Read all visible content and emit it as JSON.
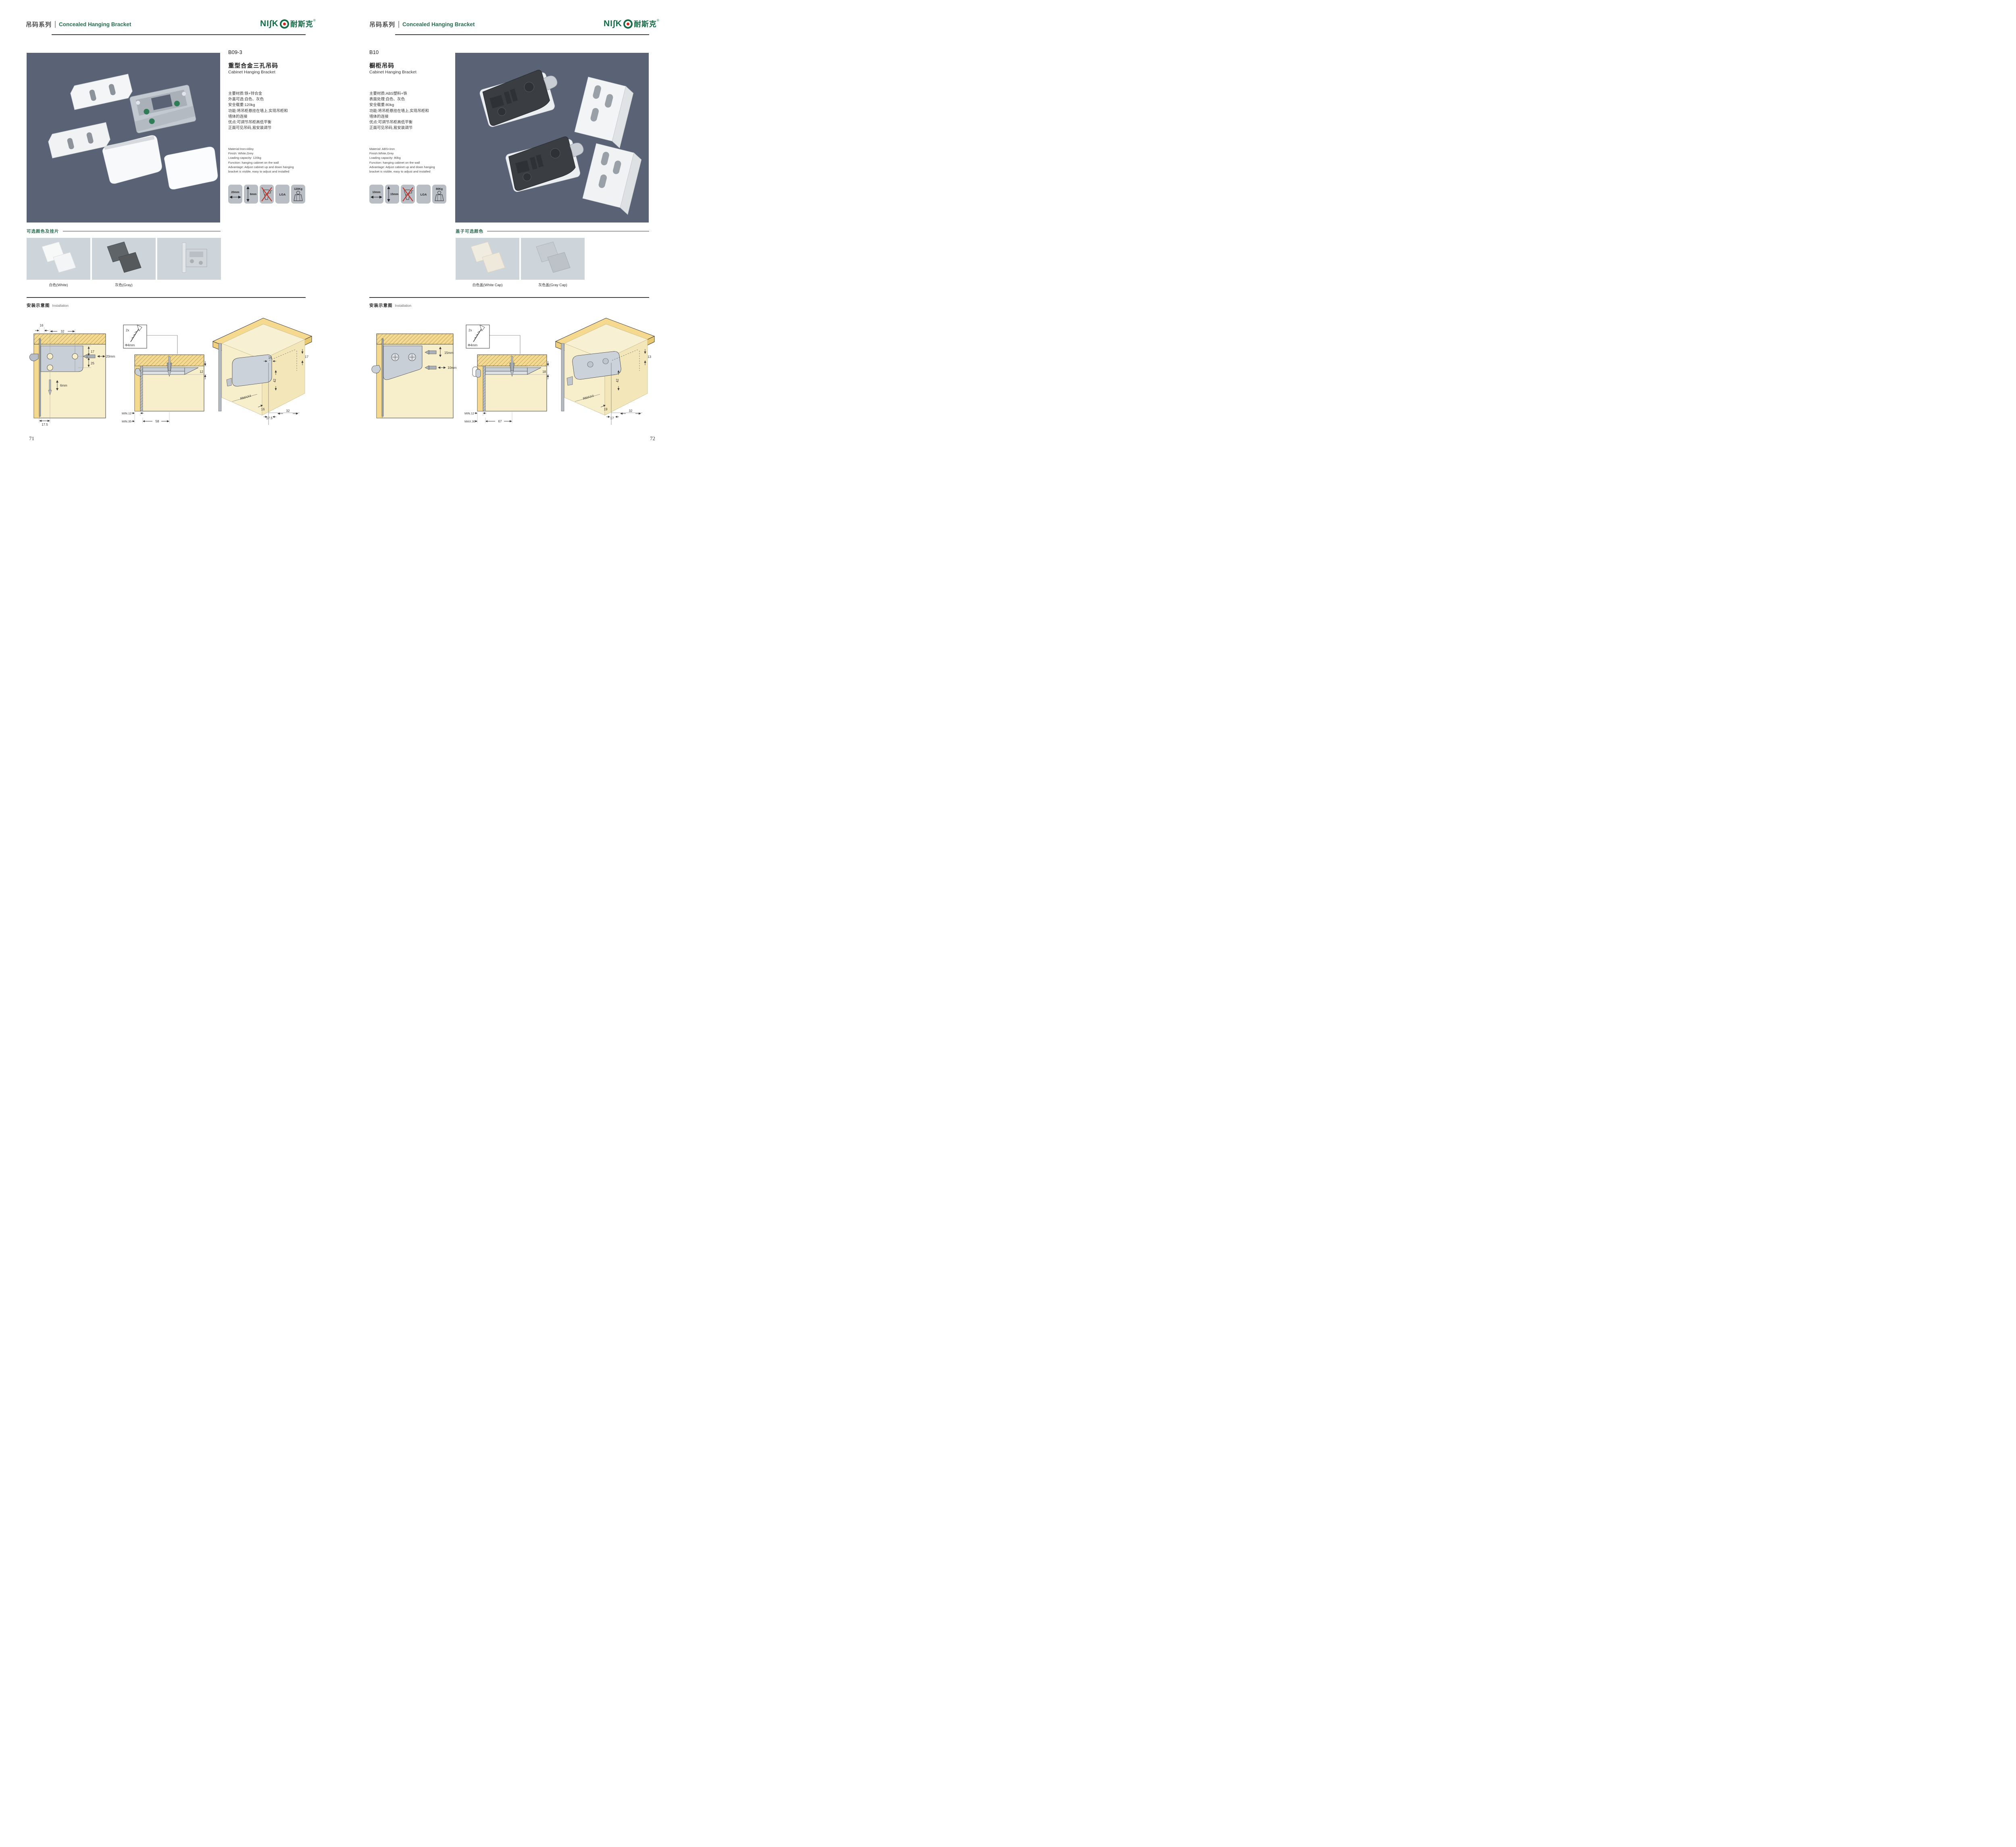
{
  "brand": {
    "logo_prefix": "NI∫K",
    "logo_cn": "耐斯克",
    "registered": "®"
  },
  "header": {
    "series_cn": "吊码系列",
    "series_en": "Concealed Hanging Bracket"
  },
  "pages": [
    {
      "product": {
        "model": "B09-3",
        "name_cn": "重型合金三孔吊码",
        "name_en": "Cabinet Hanging Bracket",
        "specs_cn": [
          "主要材质:铁+锌合金",
          "外盖可选:白色、灰色",
          "安全载重:120kg",
          "功能:将吊柜悬挂在墙上,实现吊柜和",
          "墙体的连接",
          "优点:可调节吊柜高低平衡",
          "正面可见吊码,易安装调节"
        ],
        "specs_en": [
          "Material:Iron+Alloy",
          "Finish: White,Grey",
          "Loading capacity: 120kg",
          "Function: hanging cabinet on the wall",
          "Advantage: Adjust cabinet up and down hanging",
          "bracket is visible, easy to adjust and installed"
        ],
        "icons": {
          "width_label": "20mm",
          "height_label": "6mm",
          "cert_label": "LGA",
          "load_label": "120Kg"
        }
      },
      "colors": {
        "title": "可选颜色及挂片",
        "labels": [
          "白色(White)",
          "灰色(Gray)"
        ]
      },
      "installation": {
        "title_cn": "安装示意图",
        "title_en": "Installation",
        "d1": {
          "off": "16",
          "pitch": "32",
          "top": "17",
          "gap": "25",
          "drill_h": "20mm",
          "drill_v": "6mm",
          "bottom": "17.5"
        },
        "d2": {
          "qty": "2x",
          "dia": "Φ4mm",
          "side": "12",
          "b1": "MIN.12",
          "b2": "MIN.35",
          "span": "58"
        },
        "d3": {
          "a": "17",
          "b": "16",
          "c": "42",
          "r": "RMAX4",
          "d": "16",
          "e": "17.5",
          "f": "32"
        }
      },
      "page_number": "71"
    },
    {
      "product": {
        "model": "B10",
        "name_cn": "橱柜吊码",
        "name_en": "Cabinet Hanging Bracket",
        "specs_cn": [
          "主要材质:ABS塑料+铁",
          "表面处理:白色、灰色",
          "安全载重:80kg",
          "功能:将吊柜悬挂在墙上,实现吊柜和",
          "墙体的连接",
          "优点:可调节吊柜高低平衡",
          "正面可见吊码,易安装调节"
        ],
        "specs_en": [
          "Material: ABS+iron",
          "Finish:White,Grey",
          "Loading capacity: 80kg",
          "Function: hanging cabinet on the wall",
          "Advantage: Adjust cabinet up and down hanging",
          "bracket is visible, easy to adjust and installed"
        ],
        "icons": {
          "width_label": "10mm",
          "height_label": "15mm",
          "cert_label": "LGA",
          "load_label": "80Kg"
        }
      },
      "colors": {
        "title": "盖子可选颜色",
        "labels": [
          "白色盖(White Cap)",
          "灰色盖(Gray Cap)"
        ]
      },
      "installation": {
        "title_cn": "安装示意图",
        "title_en": "Installation",
        "d1": {
          "v": "15mm",
          "h": "10mm"
        },
        "d2": {
          "qty": "2x",
          "dia": "Φ4mm",
          "side": "18",
          "b1": "MIN.12",
          "b2": "MAX.30",
          "span": "67"
        },
        "d3": {
          "a": "13",
          "c": "42",
          "r": "RMAX4",
          "d": "19",
          "e": "17",
          "f": "32"
        }
      },
      "page_number": "72"
    }
  ],
  "colors_meta": {
    "accent_green": "#2a6e52",
    "logo_green": "#176a47",
    "logo_red": "#d2251c",
    "photo_bg": "#5a6375",
    "swatch_bg": "#ced5da",
    "diagram_cream": "#f7eecb",
    "diagram_yellow": "#f5d98e"
  }
}
